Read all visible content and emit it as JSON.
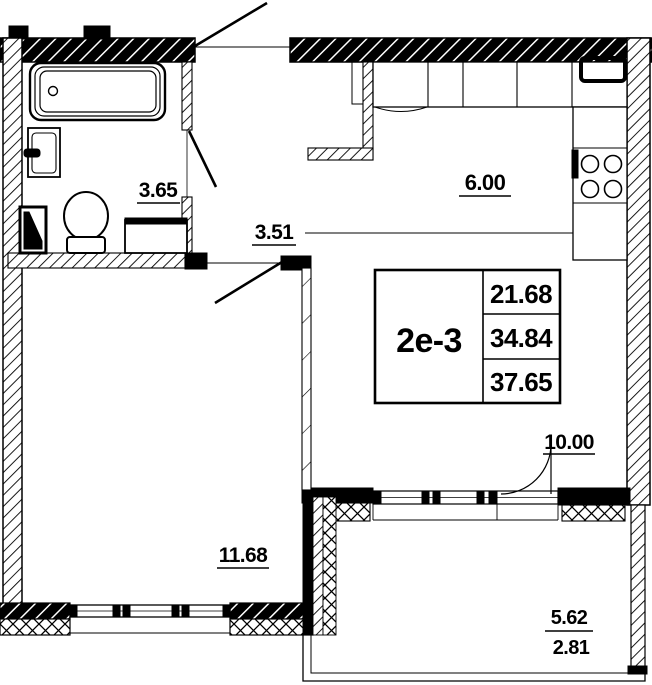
{
  "unit_table": {
    "unit_type": "2е-3",
    "areas": [
      "21.68",
      "34.84",
      "37.65"
    ]
  },
  "room_areas": {
    "bathroom": "3.65",
    "hallway": "3.51",
    "kitchen": "6.00",
    "living_room": "10.00",
    "bedroom": "11.68",
    "balcony_full": "5.62",
    "balcony_reduced": "2.81"
  },
  "colors": {
    "ink": "#000000",
    "paper": "#ffffff"
  }
}
